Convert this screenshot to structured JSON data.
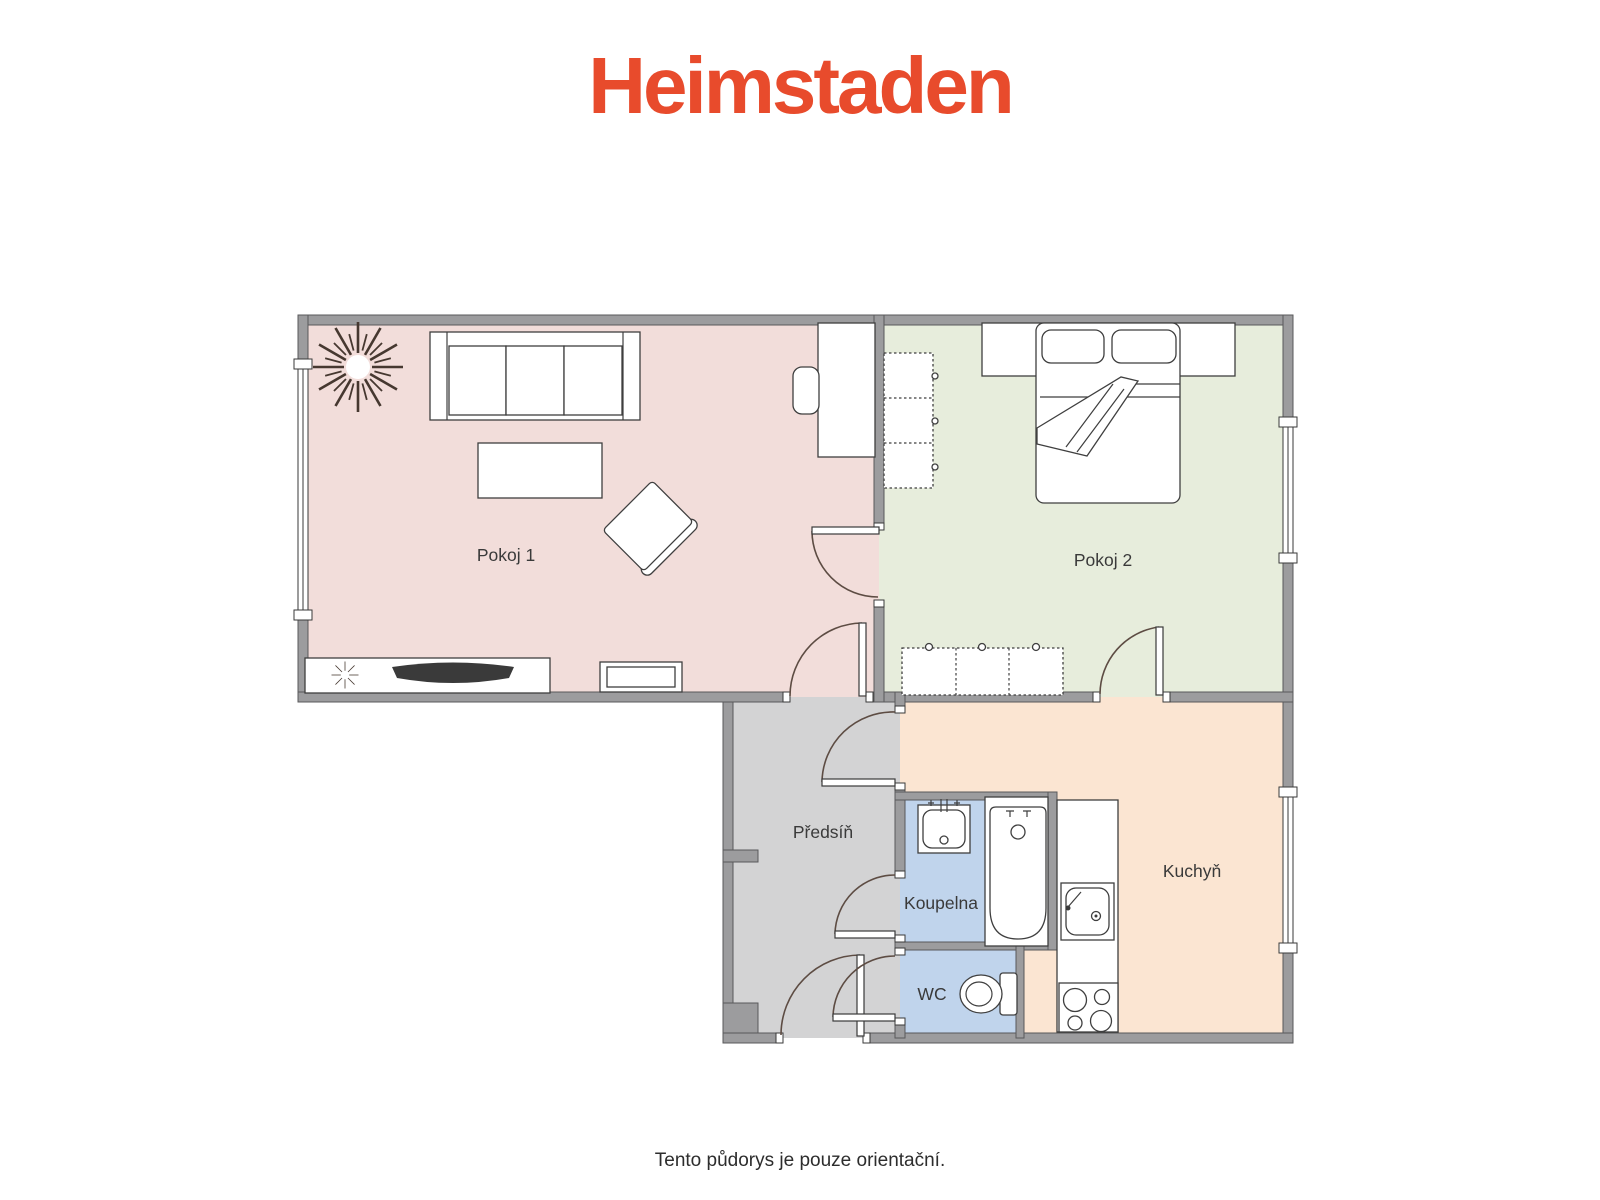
{
  "header": {
    "logo_text": "Heimstaden",
    "logo_color": "#E84B2C"
  },
  "plan": {
    "wall_color": "#9C9C9E",
    "rooms": [
      {
        "id": "pokoj-1",
        "label": "Pokoj 1",
        "color": "#F2DDDA"
      },
      {
        "id": "pokoj-2",
        "label": "Pokoj 2",
        "color": "#E7EDDC"
      },
      {
        "id": "predsin",
        "label": "Předsíň",
        "color": "#D3D3D4"
      },
      {
        "id": "koupelna",
        "label": "Koupelna",
        "color": "#C0D4EC"
      },
      {
        "id": "wc",
        "label": "WC",
        "color": "#C0D4EC"
      },
      {
        "id": "kuchyn",
        "label": "Kuchyň",
        "color": "#FBE5D2"
      }
    ]
  },
  "footer": {
    "note": "Tento půdorys je pouze orientační."
  }
}
